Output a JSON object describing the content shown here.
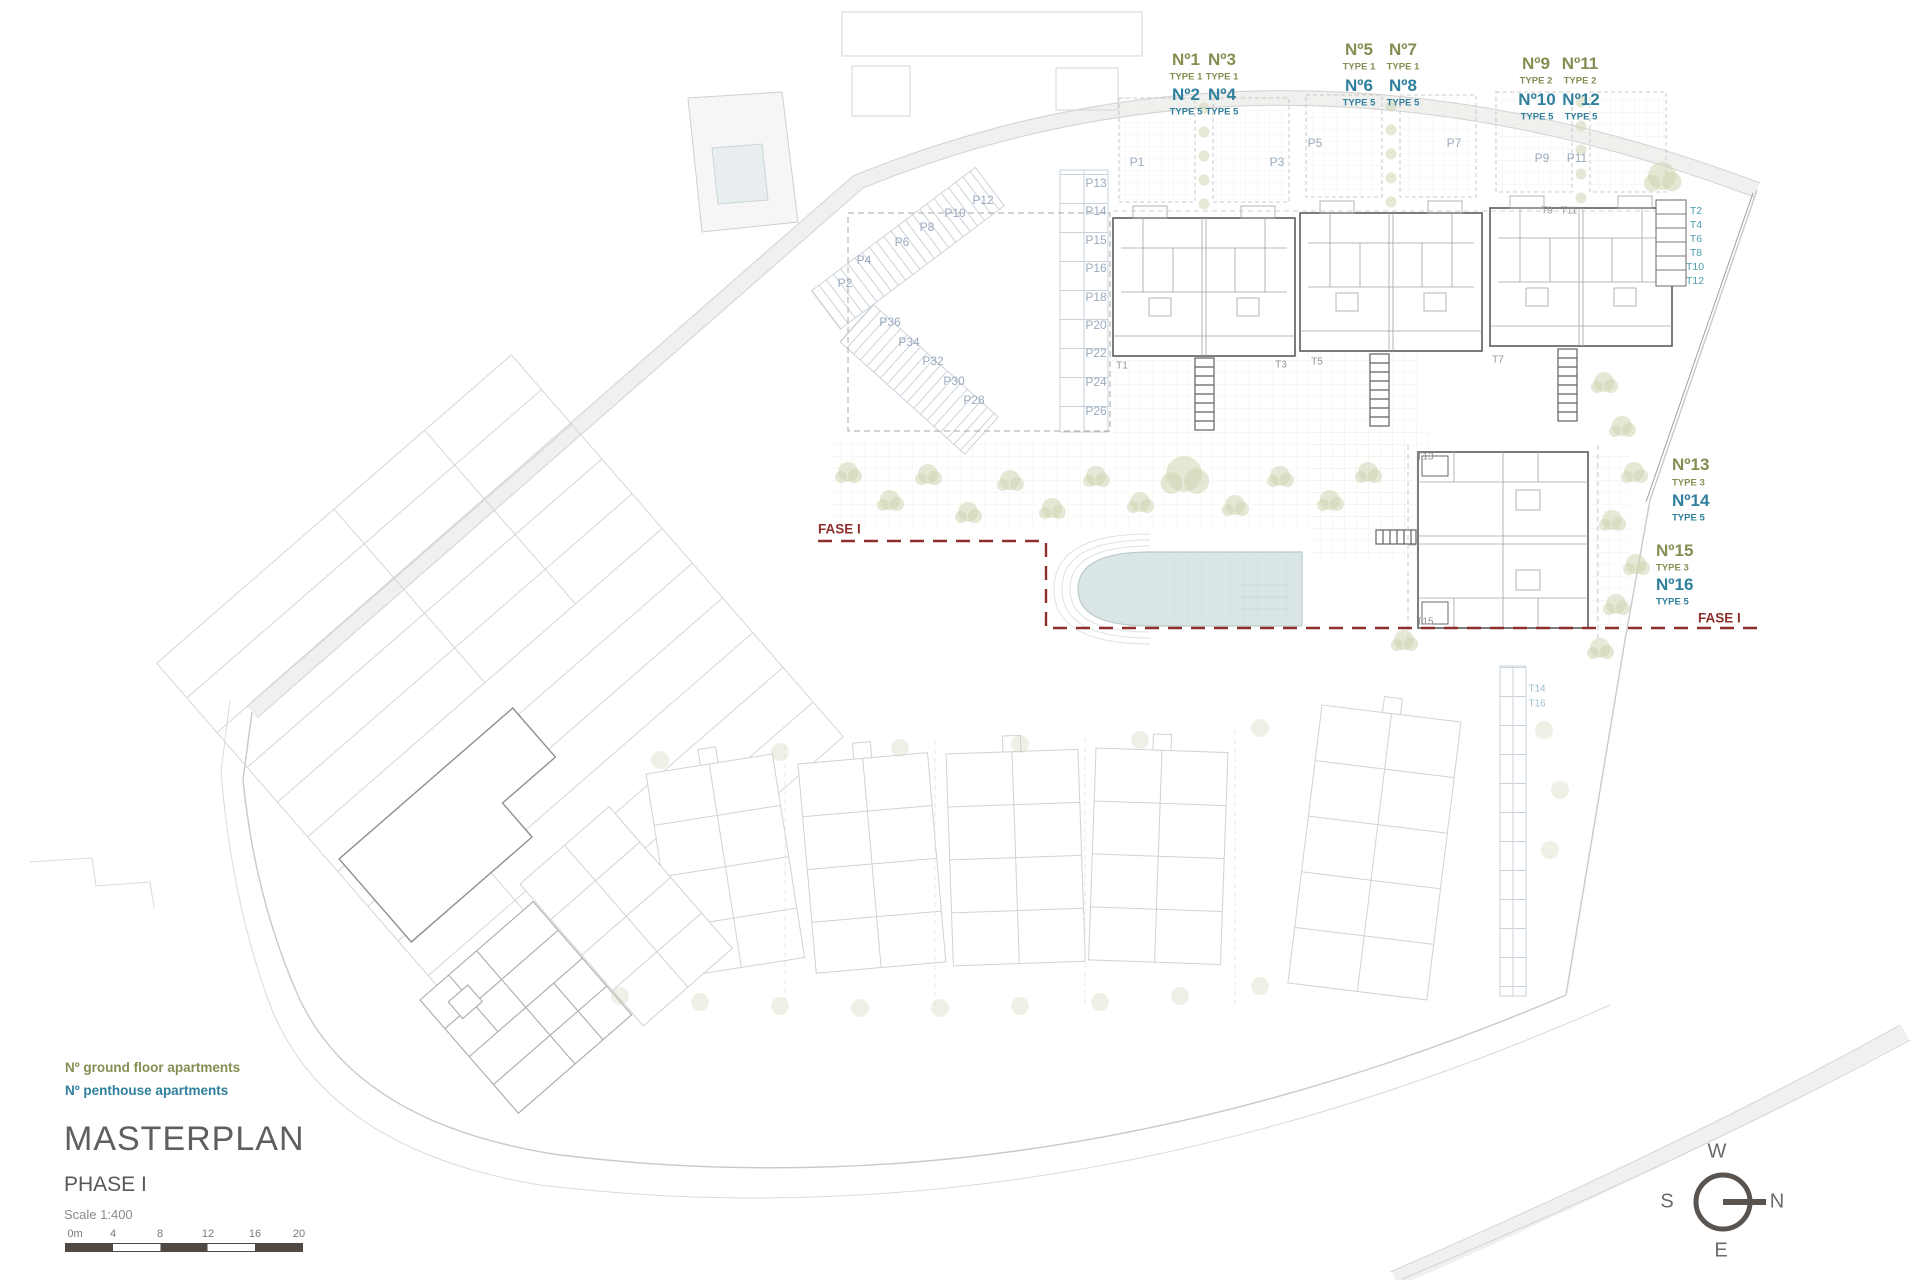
{
  "title_block": {
    "title": "MASTERPLAN",
    "phase": "PHASE I",
    "scale_label": "Scale 1:400"
  },
  "legend": {
    "ground_floor": {
      "label": "Nº ground floor apartments",
      "color": "#878d52"
    },
    "penthouse": {
      "label": "Nº penthouse apartments",
      "color": "#2f7f9d"
    }
  },
  "scale_bar": {
    "ticks": [
      {
        "text": "0m",
        "x": 10
      },
      {
        "text": "4",
        "x": 48
      },
      {
        "text": "8",
        "x": 95
      },
      {
        "text": "12",
        "x": 143
      },
      {
        "text": "16",
        "x": 190
      },
      {
        "text": "20",
        "x": 234
      }
    ]
  },
  "compass": {
    "top": "W",
    "right": "N",
    "bottom": "E",
    "left": "S"
  },
  "colors": {
    "ground_floor_text": "#878d52",
    "penthouse_text": "#2f7f9d",
    "parking_text": "#9aaabe",
    "stair_gray_text": "#90959a",
    "stair_teal_text": "#4d9dad",
    "phase_boundary": "#8d2f2a",
    "pool_fill": "#dae6e6",
    "vegetation": "#cdd6b2"
  },
  "plan": {
    "labels": [
      {
        "text": "Nº1",
        "cls": "g",
        "x": 1186,
        "y": 60
      },
      {
        "text": "Nº3",
        "cls": "g",
        "x": 1222,
        "y": 60
      },
      {
        "text": "TYPE 1",
        "cls": "gt",
        "x": 1186,
        "y": 77
      },
      {
        "text": "TYPE 1",
        "cls": "gt",
        "x": 1222,
        "y": 77
      },
      {
        "text": "Nº2",
        "cls": "b",
        "x": 1186,
        "y": 95
      },
      {
        "text": "Nº4",
        "cls": "b",
        "x": 1222,
        "y": 95
      },
      {
        "text": "TYPE 5",
        "cls": "bt",
        "x": 1186,
        "y": 112
      },
      {
        "text": "TYPE 5",
        "cls": "bt",
        "x": 1222,
        "y": 112
      },
      {
        "text": "Nº5",
        "cls": "g",
        "x": 1359,
        "y": 50
      },
      {
        "text": "Nº7",
        "cls": "g",
        "x": 1403,
        "y": 50
      },
      {
        "text": "TYPE 1",
        "cls": "gt",
        "x": 1359,
        "y": 67
      },
      {
        "text": "TYPE 1",
        "cls": "gt",
        "x": 1403,
        "y": 67
      },
      {
        "text": "Nº6",
        "cls": "b",
        "x": 1359,
        "y": 86
      },
      {
        "text": "Nº8",
        "cls": "b",
        "x": 1403,
        "y": 86
      },
      {
        "text": "TYPE 5",
        "cls": "bt",
        "x": 1359,
        "y": 103
      },
      {
        "text": "TYPE 5",
        "cls": "bt",
        "x": 1403,
        "y": 103
      },
      {
        "text": "Nº9",
        "cls": "g",
        "x": 1536,
        "y": 64
      },
      {
        "text": "Nº11",
        "cls": "g",
        "x": 1580,
        "y": 64
      },
      {
        "text": "TYPE 2",
        "cls": "gt",
        "x": 1536,
        "y": 81
      },
      {
        "text": "TYPE 2",
        "cls": "gt",
        "x": 1580,
        "y": 81
      },
      {
        "text": "Nº10",
        "cls": "b",
        "x": 1537,
        "y": 100
      },
      {
        "text": "Nº12",
        "cls": "b",
        "x": 1581,
        "y": 100
      },
      {
        "text": "TYPE 5",
        "cls": "bt",
        "x": 1537,
        "y": 117
      },
      {
        "text": "TYPE 5",
        "cls": "bt",
        "x": 1581,
        "y": 117
      },
      {
        "text": "Nº13",
        "cls": "g left",
        "x": 1672,
        "y": 465
      },
      {
        "text": "TYPE 3",
        "cls": "gt left",
        "x": 1672,
        "y": 483
      },
      {
        "text": "Nº14",
        "cls": "b left",
        "x": 1672,
        "y": 501
      },
      {
        "text": "TYPE 5",
        "cls": "bt left",
        "x": 1672,
        "y": 518
      },
      {
        "text": "Nº15",
        "cls": "g left",
        "x": 1656,
        "y": 551
      },
      {
        "text": "TYPE 3",
        "cls": "gt left",
        "x": 1656,
        "y": 568
      },
      {
        "text": "Nº16",
        "cls": "b left",
        "x": 1656,
        "y": 585
      },
      {
        "text": "TYPE 5",
        "cls": "bt left",
        "x": 1656,
        "y": 602
      },
      {
        "text": "FASE I",
        "cls": "fase",
        "x": 818,
        "y": 529
      },
      {
        "text": "FASE I",
        "cls": "fase",
        "x": 1698,
        "y": 618
      },
      {
        "text": "P2",
        "cls": "p",
        "x": 845,
        "y": 283
      },
      {
        "text": "P4",
        "cls": "p",
        "x": 864,
        "y": 260
      },
      {
        "text": "P6",
        "cls": "p",
        "x": 902,
        "y": 242
      },
      {
        "text": "P8",
        "cls": "p",
        "x": 927,
        "y": 227
      },
      {
        "text": "P10",
        "cls": "p",
        "x": 955,
        "y": 213
      },
      {
        "text": "P12",
        "cls": "p",
        "x": 983,
        "y": 200
      },
      {
        "text": "P36",
        "cls": "p",
        "x": 890,
        "y": 322
      },
      {
        "text": "P34",
        "cls": "p",
        "x": 909,
        "y": 342
      },
      {
        "text": "P32",
        "cls": "p",
        "x": 933,
        "y": 361
      },
      {
        "text": "P30",
        "cls": "p",
        "x": 954,
        "y": 381
      },
      {
        "text": "P28",
        "cls": "p",
        "x": 974,
        "y": 400
      },
      {
        "text": "P13",
        "cls": "p",
        "x": 1096,
        "y": 183
      },
      {
        "text": "P14",
        "cls": "p",
        "x": 1096,
        "y": 211
      },
      {
        "text": "P15",
        "cls": "p",
        "x": 1096,
        "y": 240
      },
      {
        "text": "P16",
        "cls": "p",
        "x": 1096,
        "y": 268
      },
      {
        "text": "P18",
        "cls": "p",
        "x": 1096,
        "y": 297
      },
      {
        "text": "P20",
        "cls": "p",
        "x": 1096,
        "y": 325
      },
      {
        "text": "P22",
        "cls": "p",
        "x": 1096,
        "y": 353
      },
      {
        "text": "P24",
        "cls": "p",
        "x": 1096,
        "y": 382
      },
      {
        "text": "P26",
        "cls": "p",
        "x": 1096,
        "y": 411
      },
      {
        "text": "P1",
        "cls": "p",
        "x": 1137,
        "y": 162
      },
      {
        "text": "P3",
        "cls": "p",
        "x": 1277,
        "y": 162
      },
      {
        "text": "P5",
        "cls": "p",
        "x": 1315,
        "y": 143
      },
      {
        "text": "P7",
        "cls": "p",
        "x": 1454,
        "y": 143
      },
      {
        "text": "P9",
        "cls": "p",
        "x": 1542,
        "y": 158
      },
      {
        "text": "P11",
        "cls": "p",
        "x": 1577,
        "y": 158
      },
      {
        "text": "T1",
        "cls": "tg",
        "x": 1122,
        "y": 366
      },
      {
        "text": "T3",
        "cls": "tg",
        "x": 1281,
        "y": 365
      },
      {
        "text": "T5",
        "cls": "tg",
        "x": 1317,
        "y": 362
      },
      {
        "text": "T7",
        "cls": "tg",
        "x": 1498,
        "y": 360
      },
      {
        "text": "T9",
        "cls": "tg",
        "x": 1547,
        "y": 211
      },
      {
        "text": "T11",
        "cls": "tg",
        "x": 1569,
        "y": 211
      },
      {
        "text": "T13",
        "cls": "tg",
        "x": 1425,
        "y": 457
      },
      {
        "text": "T15",
        "cls": "tg",
        "x": 1425,
        "y": 622
      },
      {
        "text": "T2",
        "cls": "tt",
        "x": 1696,
        "y": 211
      },
      {
        "text": "T4",
        "cls": "tt",
        "x": 1696,
        "y": 225
      },
      {
        "text": "T6",
        "cls": "tt",
        "x": 1696,
        "y": 239
      },
      {
        "text": "T8",
        "cls": "tt",
        "x": 1696,
        "y": 253
      },
      {
        "text": "T10",
        "cls": "tt",
        "x": 1695,
        "y": 267
      },
      {
        "text": "T12",
        "cls": "tt",
        "x": 1695,
        "y": 281
      },
      {
        "text": "T14",
        "cls": "tt2",
        "x": 1537,
        "y": 689
      },
      {
        "text": "T16",
        "cls": "tt2",
        "x": 1537,
        "y": 704
      }
    ]
  }
}
